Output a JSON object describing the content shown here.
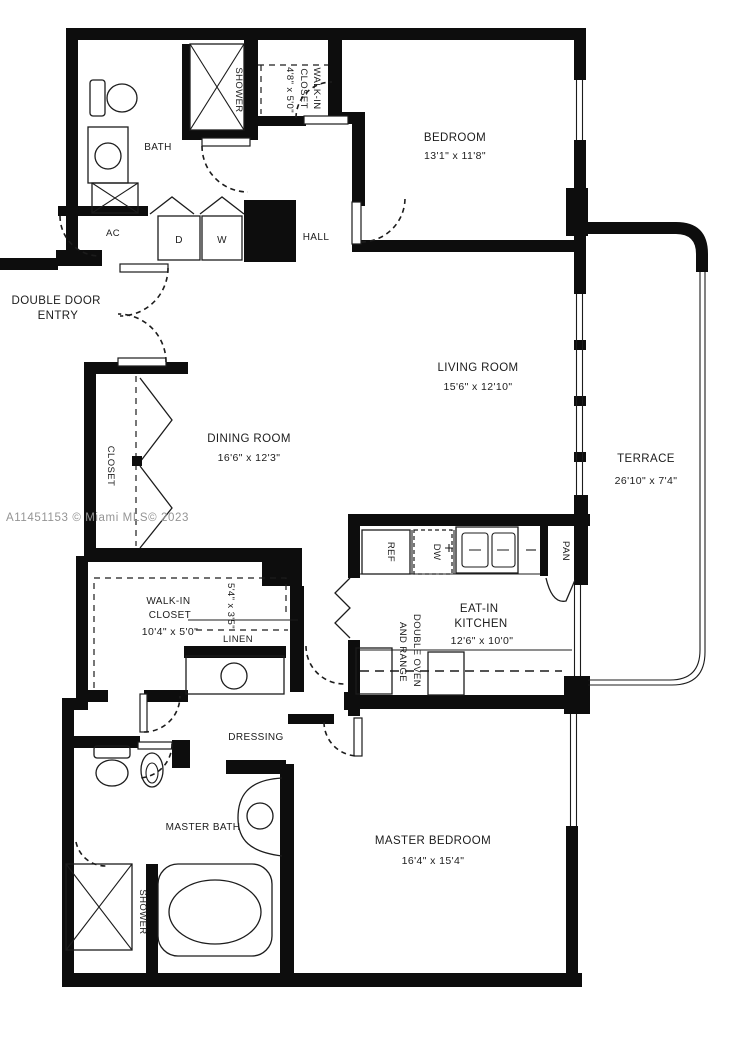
{
  "watermark": "A11451153 © Miami MLS© 2023",
  "colors": {
    "line": "#1c1c1c",
    "wall": "#0d0d0d",
    "watermark": "#949494"
  },
  "rooms": {
    "bedroom": {
      "name": "BEDROOM",
      "dims": "13'1\" x 11'8\""
    },
    "bath": {
      "name": "BATH"
    },
    "shower_bath": {
      "name": "SHOWER"
    },
    "walkin_top": {
      "line1": "WALK-IN",
      "line2": "CLOSET",
      "dims": "4'8\" x 5'0\""
    },
    "ac": {
      "name": "AC"
    },
    "dryer": {
      "name": "D"
    },
    "washer": {
      "name": "W"
    },
    "hall": {
      "name": "HALL"
    },
    "entry": {
      "line1": "DOUBLE DOOR",
      "line2": "ENTRY"
    },
    "living": {
      "name": "LIVING ROOM",
      "dims": "15'6\" x 12'10\""
    },
    "dining": {
      "name": "DINING ROOM",
      "dims": "16'6\" x 12'3\""
    },
    "closet": {
      "name": "CLOSET"
    },
    "terrace": {
      "name": "TERRACE",
      "dims": "26'10\" x 7'4\""
    },
    "kitchen": {
      "line1": "EAT-IN",
      "line2": "KITCHEN",
      "dims": "12'6\" x 10'0\""
    },
    "ref": {
      "name": "REF"
    },
    "dw": {
      "name": "DW"
    },
    "pan": {
      "name": "PAN"
    },
    "double_oven": {
      "line1": "DOUBLE OVEN",
      "line2": "AND RANGE"
    },
    "walkin_master": {
      "line1": "WALK-IN",
      "line2": "CLOSET",
      "dims": "10'4\" x 5'0\""
    },
    "closet_ext": {
      "dims": "5'4\" x 3'5\""
    },
    "linen": {
      "name": "LINEN"
    },
    "dressing": {
      "name": "DRESSING"
    },
    "master_bath": {
      "name": "MASTER BATH"
    },
    "shower_master": {
      "name": "SHOWER"
    },
    "master_bedroom": {
      "name": "MASTER BEDROOM",
      "dims": "16'4\" x 15'4\""
    }
  }
}
